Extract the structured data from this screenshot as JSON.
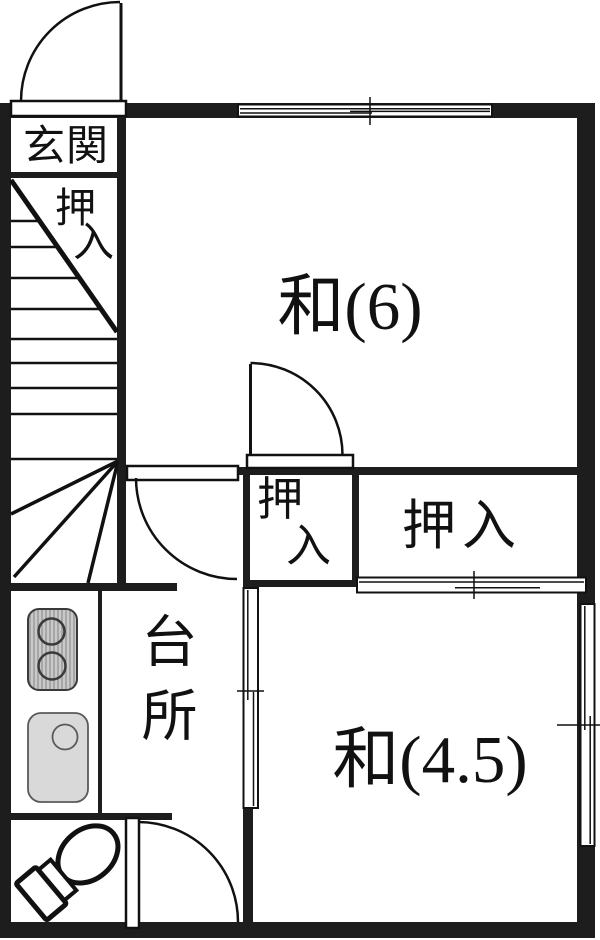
{
  "plan_title": "floor-plan",
  "rooms": {
    "genkan": {
      "label": "玄関"
    },
    "stair_closet": {
      "label": "押入",
      "char_top": "押",
      "char_bottom": "入"
    },
    "wa6": {
      "label": "和(6)"
    },
    "small_closet": {
      "label": "押入",
      "char_top": "押",
      "char_bottom": "入"
    },
    "large_closet": {
      "label": "押入"
    },
    "kitchen": {
      "label": "台所"
    },
    "wa45": {
      "label": "和(4.5)"
    }
  },
  "icons": {
    "stove": "two-burner-stove-icon",
    "sink": "kitchen-sink-icon",
    "toilet": "toilet-icon",
    "doors": "swing-door-arc-icon",
    "stairs": "winder-staircase-icon",
    "windows": "sliding-window-icon"
  },
  "colors": {
    "wall": "#1d1d1d",
    "line": "#111111",
    "stove_fill": "#c9c9c9",
    "sink_fill": "#d9d9d9",
    "background": "#ffffff"
  }
}
